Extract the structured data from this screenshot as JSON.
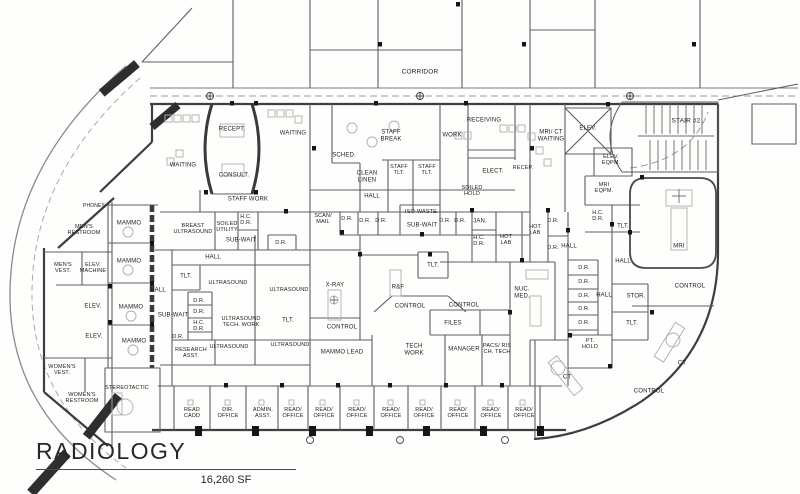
{
  "header": {
    "title": "RADIOLOGY",
    "area": "16,260 SF"
  },
  "floorplan": {
    "corridor_label": "CORRIDOR",
    "labels": [
      {
        "t": "CORRIDOR",
        "x": 420,
        "y": 72,
        "s": 6.5
      },
      {
        "t": "RECEPT.",
        "x": 232,
        "y": 130
      },
      {
        "t": "WAITING",
        "x": 293,
        "y": 134
      },
      {
        "t": "WAITING",
        "x": 183,
        "y": 166
      },
      {
        "t": "CONSULT.",
        "x": 234,
        "y": 176
      },
      {
        "t": "SCHED.",
        "x": 344,
        "y": 156
      },
      {
        "t": "STAFF\nBREAK",
        "x": 391,
        "y": 136
      },
      {
        "t": "CLEAN\nLINEN",
        "x": 367,
        "y": 177
      },
      {
        "t": "STAFF\nTLT.",
        "x": 399,
        "y": 170,
        "s": 5.5
      },
      {
        "t": "STAFF\nTLT.",
        "x": 427,
        "y": 170,
        "s": 5.5
      },
      {
        "t": "WORK",
        "x": 452,
        "y": 136
      },
      {
        "t": "RECEIVING",
        "x": 484,
        "y": 121
      },
      {
        "t": "ELECT.",
        "x": 493,
        "y": 172
      },
      {
        "t": "RECEP.",
        "x": 523,
        "y": 168,
        "s": 5.5
      },
      {
        "t": "MRI/ CT\nWAITING",
        "x": 551,
        "y": 136
      },
      {
        "t": "ELEV.",
        "x": 588,
        "y": 129
      },
      {
        "t": "STAIR #2",
        "x": 686,
        "y": 121,
        "s": 6.5
      },
      {
        "t": "ELEV.\nEQPM.",
        "x": 611,
        "y": 160,
        "s": 5.5
      },
      {
        "t": "MRI\nEQPM.",
        "x": 604,
        "y": 188,
        "s": 5.5
      },
      {
        "t": "SOILED\nHOLD",
        "x": 472,
        "y": 191,
        "s": 5.5
      },
      {
        "t": "STAFF WORK",
        "x": 248,
        "y": 200
      },
      {
        "t": "HALL",
        "x": 372,
        "y": 197
      },
      {
        "t": "MEN'S\nRESTROOM",
        "x": 84,
        "y": 230,
        "s": 5.5
      },
      {
        "t": "PHONES",
        "x": 94,
        "y": 207,
        "s": 5
      },
      {
        "t": "MEN'S\nVEST.",
        "x": 63,
        "y": 268,
        "s": 5.5
      },
      {
        "t": "ELEV.\nMACHINE",
        "x": 93,
        "y": 268,
        "s": 5.5
      },
      {
        "t": "ELEV.",
        "x": 93,
        "y": 307
      },
      {
        "t": "ELEV.",
        "x": 94,
        "y": 337
      },
      {
        "t": "WOMEN'S\nVEST.",
        "x": 62,
        "y": 370,
        "s": 5.5
      },
      {
        "t": "WOMEN'S\nRESTROOM",
        "x": 82,
        "y": 398,
        "s": 5.5
      },
      {
        "t": "MAMMO",
        "x": 129,
        "y": 224
      },
      {
        "t": "MAMMO",
        "x": 129,
        "y": 262
      },
      {
        "t": "MAMMO",
        "x": 131,
        "y": 308
      },
      {
        "t": "MAMMO",
        "x": 134,
        "y": 342
      },
      {
        "t": "BREAST\nULTRASOUND",
        "x": 193,
        "y": 229,
        "s": 5.5
      },
      {
        "t": "SOILED\nUTILITY",
        "x": 227,
        "y": 227,
        "s": 5.5
      },
      {
        "t": "H.C.\nD.R.",
        "x": 246,
        "y": 220,
        "s": 5.5
      },
      {
        "t": "SUB-WAIT",
        "x": 241,
        "y": 241
      },
      {
        "t": "HALL",
        "x": 213,
        "y": 258
      },
      {
        "t": "HALL",
        "x": 158,
        "y": 291
      },
      {
        "t": "TLT.",
        "x": 186,
        "y": 277
      },
      {
        "t": "ULTRASOUND",
        "x": 228,
        "y": 283,
        "s": 5.5
      },
      {
        "t": "ULTRASOUND",
        "x": 289,
        "y": 290,
        "s": 5.5
      },
      {
        "t": "D.R.",
        "x": 281,
        "y": 243,
        "s": 5.5
      },
      {
        "t": "D.R.",
        "x": 199,
        "y": 301,
        "s": 5.5
      },
      {
        "t": "D.R.",
        "x": 199,
        "y": 312,
        "s": 5.5
      },
      {
        "t": "SUB-WAIT",
        "x": 173,
        "y": 316
      },
      {
        "t": "H.C.\nD.R.",
        "x": 199,
        "y": 326,
        "s": 5.5
      },
      {
        "t": "D.R.",
        "x": 178,
        "y": 337,
        "s": 5.5
      },
      {
        "t": "ULTRASOUND\nTECH. WORK",
        "x": 241,
        "y": 322,
        "s": 5.5
      },
      {
        "t": "TLT.",
        "x": 288,
        "y": 321
      },
      {
        "t": "RESEARCH\nASST.",
        "x": 191,
        "y": 353,
        "s": 5.5
      },
      {
        "t": "ULTRASOUND",
        "x": 229,
        "y": 347,
        "s": 5.5
      },
      {
        "t": "ULTRASOUND",
        "x": 290,
        "y": 345,
        "s": 5.5
      },
      {
        "t": "STEREOTACTIC",
        "x": 127,
        "y": 388,
        "s": 5.5
      },
      {
        "t": "SCAN/\nMAIL",
        "x": 323,
        "y": 219,
        "s": 5.5
      },
      {
        "t": "D.R.",
        "x": 347,
        "y": 219,
        "s": 5.5
      },
      {
        "t": "D.R.",
        "x": 365,
        "y": 221,
        "s": 5.5
      },
      {
        "t": "D.R.",
        "x": 381,
        "y": 221,
        "s": 5.5
      },
      {
        "t": "ISO-WASTE",
        "x": 421,
        "y": 212,
        "s": 5.5
      },
      {
        "t": "SUB-WAIT",
        "x": 422,
        "y": 226
      },
      {
        "t": "D.R.",
        "x": 445,
        "y": 221,
        "s": 5.5
      },
      {
        "t": "D.R.",
        "x": 460,
        "y": 221,
        "s": 5.5
      },
      {
        "t": "JAN.",
        "x": 480,
        "y": 222
      },
      {
        "t": "H.C.\nD.R.",
        "x": 479,
        "y": 241,
        "s": 5.5
      },
      {
        "t": "HOT\nLAB",
        "x": 506,
        "y": 240,
        "s": 5.5
      },
      {
        "t": "HOT\nLAB",
        "x": 535,
        "y": 230,
        "s": 5.5
      },
      {
        "t": "D.R.",
        "x": 553,
        "y": 221,
        "s": 5.5
      },
      {
        "t": "D.R.",
        "x": 553,
        "y": 248,
        "s": 5.5
      },
      {
        "t": "H.C.\nD.R.",
        "x": 598,
        "y": 216,
        "s": 5.5
      },
      {
        "t": "TLT.",
        "x": 623,
        "y": 227
      },
      {
        "t": "HALL",
        "x": 569,
        "y": 247
      },
      {
        "t": "HALL",
        "x": 623,
        "y": 262
      },
      {
        "t": "HALL",
        "x": 604,
        "y": 296
      },
      {
        "t": "D.R.",
        "x": 584,
        "y": 268,
        "s": 5.5
      },
      {
        "t": "D.R.",
        "x": 584,
        "y": 282,
        "s": 5.5
      },
      {
        "t": "D.R.",
        "x": 584,
        "y": 296,
        "s": 5.5
      },
      {
        "t": "D.R.",
        "x": 584,
        "y": 309,
        "s": 5.5
      },
      {
        "t": "D.R.",
        "x": 584,
        "y": 323,
        "s": 5.5
      },
      {
        "t": "STOR.",
        "x": 636,
        "y": 297
      },
      {
        "t": "TLT.",
        "x": 632,
        "y": 324
      },
      {
        "t": "PT.\nHOLD",
        "x": 590,
        "y": 344,
        "s": 5.5
      },
      {
        "t": "X-RAY",
        "x": 335,
        "y": 286
      },
      {
        "t": "TLT.",
        "x": 433,
        "y": 266
      },
      {
        "t": "R&F",
        "x": 398,
        "y": 288
      },
      {
        "t": "CONTROL",
        "x": 342,
        "y": 328
      },
      {
        "t": "CONTROL",
        "x": 410,
        "y": 307
      },
      {
        "t": "CONTROL",
        "x": 464,
        "y": 306
      },
      {
        "t": "FILES",
        "x": 453,
        "y": 324
      },
      {
        "t": "MAMMO LEAD",
        "x": 342,
        "y": 353
      },
      {
        "t": "TECH\nWORK",
        "x": 414,
        "y": 350
      },
      {
        "t": "MANAGER",
        "x": 464,
        "y": 350
      },
      {
        "t": "PACS/ RIS\nCH. TECH",
        "x": 497,
        "y": 349,
        "s": 5.5
      },
      {
        "t": "NUC.\nMED.",
        "x": 522,
        "y": 293
      },
      {
        "t": "MRI",
        "x": 679,
        "y": 247
      },
      {
        "t": "CONTROL",
        "x": 690,
        "y": 287
      },
      {
        "t": "CT",
        "x": 567,
        "y": 378
      },
      {
        "t": "CT",
        "x": 682,
        "y": 364
      },
      {
        "t": "CONTROL",
        "x": 649,
        "y": 392
      },
      {
        "t": "READ\nCADD",
        "x": 192,
        "y": 413,
        "s": 5.5
      },
      {
        "t": "DIR.\nOFFICE",
        "x": 228,
        "y": 413,
        "s": 5.5
      },
      {
        "t": "ADMIN.\nASST.",
        "x": 263,
        "y": 413,
        "s": 5.5
      },
      {
        "t": "READ/\nOFFICE",
        "x": 293,
        "y": 413,
        "s": 5.5
      },
      {
        "t": "READ/\nOFFICE",
        "x": 324,
        "y": 413,
        "s": 5.5
      },
      {
        "t": "READ/\nOFFICE",
        "x": 357,
        "y": 413,
        "s": 5.5
      },
      {
        "t": "READ/\nOFFICE",
        "x": 391,
        "y": 413,
        "s": 5.5
      },
      {
        "t": "READ/\nOFFICE",
        "x": 424,
        "y": 413,
        "s": 5.5
      },
      {
        "t": "READ/\nOFFICE",
        "x": 458,
        "y": 413,
        "s": 5.5
      },
      {
        "t": "READ/\nOFFICE",
        "x": 491,
        "y": 413,
        "s": 5.5
      },
      {
        "t": "READ/\nOFFICE",
        "x": 524,
        "y": 413,
        "s": 5.5
      }
    ]
  }
}
